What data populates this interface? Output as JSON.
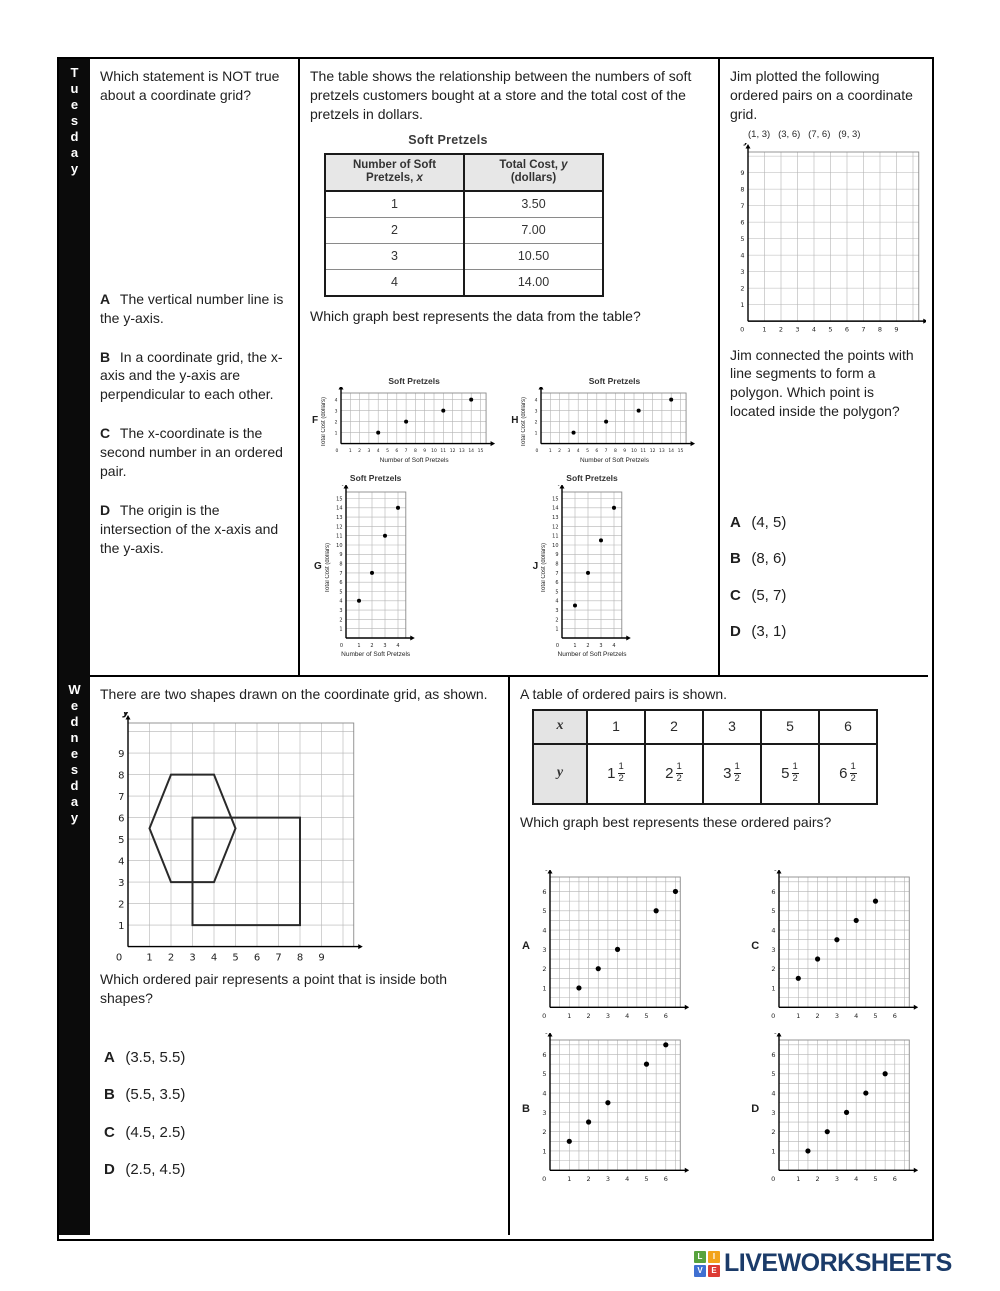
{
  "days": {
    "row1": "Tuesday",
    "row2": "Wednesday"
  },
  "tuesday": {
    "q1": {
      "question": "Which statement is NOT true about a coordinate grid?",
      "choices": [
        {
          "letter": "A",
          "text": "The vertical number line is the y-axis."
        },
        {
          "letter": "B",
          "text": "In a coordinate grid, the x-axis and the y-axis are perpendicular to each other."
        },
        {
          "letter": "C",
          "text": "The x-coordinate is the second number in an ordered pair."
        },
        {
          "letter": "D",
          "text": "The origin is the intersection of the x-axis and the y-axis."
        }
      ]
    },
    "q2": {
      "intro": "The table shows the relationship between the numbers of soft pretzels customers bought at a store and the total cost of the pretzels in dollars.",
      "table": {
        "title": "Soft Pretzels",
        "col1_line1": "Number of Soft",
        "col1_line2": "Pretzels,",
        "col1_var": "x",
        "col2_line1": "Total Cost,",
        "col2_var": "y",
        "col2_line2": "(dollars)",
        "rows": [
          {
            "x": "1",
            "cost": "3.50"
          },
          {
            "x": "2",
            "cost": "7.00"
          },
          {
            "x": "3",
            "cost": "10.50"
          },
          {
            "x": "4",
            "cost": "14.00"
          }
        ]
      },
      "question": "Which graph best represents the data from the table?"
    },
    "q3": {
      "intro": "Jim plotted the following ordered pairs on a coordinate grid.",
      "pairs": "(1, 3)   (3, 6)   (7, 6)   (9, 3)",
      "question": "Jim connected the points with line segments to form a polygon. Which point is located inside the polygon?",
      "choices": [
        {
          "letter": "A",
          "text": "(4, 5)"
        },
        {
          "letter": "B",
          "text": "(8, 6)"
        },
        {
          "letter": "C",
          "text": "(5, 7)"
        },
        {
          "letter": "D",
          "text": "(3, 1)"
        }
      ]
    }
  },
  "wednesday": {
    "q1": {
      "intro": "There are two shapes drawn on the coordinate grid, as shown.",
      "question": "Which ordered pair represents a point that is inside both shapes?",
      "choices": [
        {
          "letter": "A",
          "text": "(3.5, 5.5)"
        },
        {
          "letter": "B",
          "text": "(5.5, 3.5)"
        },
        {
          "letter": "C",
          "text": "(4.5, 2.5)"
        },
        {
          "letter": "D",
          "text": "(2.5, 4.5)"
        }
      ]
    },
    "q2": {
      "intro": "A table of ordered pairs is shown.",
      "table": {
        "x_header": "x",
        "y_header": "y",
        "x_values": [
          "1",
          "2",
          "3",
          "5",
          "6"
        ],
        "y_values": [
          {
            "whole": "1",
            "num": "1",
            "den": "2"
          },
          {
            "whole": "2",
            "num": "1",
            "den": "2"
          },
          {
            "whole": "3",
            "num": "1",
            "den": "2"
          },
          {
            "whole": "5",
            "num": "1",
            "den": "2"
          },
          {
            "whole": "6",
            "num": "1",
            "den": "2"
          }
        ]
      },
      "question": "Which graph best represents these ordered pairs?"
    }
  },
  "footer": {
    "logo_text": "LIVEWORKSHEETS",
    "logo_text_color": "#1b3b69",
    "logo_squares": [
      {
        "letter": "L",
        "color": "#57a23d"
      },
      {
        "letter": "I",
        "color": "#f2a31b"
      },
      {
        "letter": "V",
        "color": "#3f6fd1"
      },
      {
        "letter": "E",
        "color": "#dd3b33"
      }
    ]
  },
  "chart_data": {
    "f": {
      "type": "scatter",
      "label": "F",
      "title": "Soft Pretzels",
      "xlabel": "Number of Soft Pretzels",
      "ylabel": "Total Cost (dollars)",
      "axis_x": "x",
      "axis_y": "y",
      "x_ticks": [
        0,
        1,
        2,
        3,
        4,
        5,
        6,
        7,
        8,
        9,
        10,
        11,
        12,
        13,
        14,
        15
      ],
      "y_ticks": [
        1,
        2,
        3,
        4
      ],
      "x_grid_max": 15.6,
      "y_grid_max": 4.6,
      "grid_step": 1,
      "points": [
        [
          4,
          1
        ],
        [
          7,
          2
        ],
        [
          11,
          3
        ],
        [
          14,
          4
        ]
      ]
    },
    "h": {
      "type": "scatter",
      "label": "H",
      "title": "Soft Pretzels",
      "xlabel": "Number of Soft Pretzels",
      "ylabel": "Total Cost (dollars)",
      "axis_x": "x",
      "axis_y": "y",
      "x_ticks": [
        0,
        1,
        2,
        3,
        4,
        5,
        6,
        7,
        8,
        9,
        10,
        11,
        12,
        13,
        14,
        15
      ],
      "y_ticks": [
        1,
        2,
        3,
        4
      ],
      "x_grid_max": 15.6,
      "y_grid_max": 4.6,
      "grid_step": 1,
      "points": [
        [
          3.5,
          1
        ],
        [
          7,
          2
        ],
        [
          10.5,
          3
        ],
        [
          14,
          4
        ]
      ]
    },
    "g": {
      "type": "scatter",
      "label": "G",
      "title": "Soft Pretzels",
      "xlabel": "Number of Soft Pretzels",
      "ylabel": "Total Cost (dollars)",
      "axis_x": "x",
      "axis_y": "y",
      "x_ticks": [
        0,
        1,
        2,
        3,
        4
      ],
      "y_ticks": [
        1,
        2,
        3,
        4,
        5,
        6,
        7,
        8,
        9,
        10,
        11,
        12,
        13,
        14,
        15
      ],
      "x_grid_max": 4.6,
      "y_grid_max": 15.7,
      "grid_step": 1,
      "points": [
        [
          1,
          4
        ],
        [
          2,
          7
        ],
        [
          3,
          11
        ],
        [
          4,
          14
        ]
      ]
    },
    "j": {
      "type": "scatter",
      "label": "J",
      "title": "Soft Pretzels",
      "xlabel": "Number of Soft Pretzels",
      "ylabel": "Total Cost (dollars)",
      "axis_x": "x",
      "axis_y": "y",
      "x_ticks": [
        0,
        1,
        2,
        3,
        4
      ],
      "y_ticks": [
        1,
        2,
        3,
        4,
        5,
        6,
        7,
        8,
        9,
        10,
        11,
        12,
        13,
        14,
        15
      ],
      "x_grid_max": 4.6,
      "y_grid_max": 15.7,
      "grid_step": 1,
      "points": [
        [
          1,
          3.5
        ],
        [
          2,
          7
        ],
        [
          3,
          10.5
        ],
        [
          4,
          14
        ]
      ]
    },
    "jim": {
      "type": "scatter",
      "label": "",
      "title": "",
      "axis_x": "x",
      "axis_y": "y",
      "x_ticks": [
        0,
        1,
        2,
        3,
        4,
        5,
        6,
        7,
        8,
        9
      ],
      "y_ticks": [
        1,
        2,
        3,
        4,
        5,
        6,
        7,
        8,
        9
      ],
      "x_grid_max": 10.35,
      "y_grid_max": 10.25,
      "grid_step": 1,
      "points": []
    },
    "shapes": {
      "type": "scatter",
      "label": "",
      "title": "",
      "axis_x": "x",
      "axis_y": "y",
      "x_ticks": [
        0,
        1,
        2,
        3,
        4,
        5,
        6,
        7,
        8,
        9
      ],
      "y_ticks": [
        1,
        2,
        3,
        4,
        5,
        6,
        7,
        8,
        9
      ],
      "x_grid_max": 10.5,
      "y_grid_max": 10.4,
      "grid_step": 1,
      "points": [],
      "polygons": [
        [
          [
            2,
            8
          ],
          [
            4,
            8
          ],
          [
            5,
            5.5
          ],
          [
            4,
            3
          ],
          [
            2,
            3
          ],
          [
            1,
            5.5
          ]
        ],
        [
          [
            3,
            1
          ],
          [
            8,
            1
          ],
          [
            8,
            6
          ],
          [
            3,
            6
          ]
        ]
      ]
    },
    "a": {
      "type": "scatter",
      "label": "A",
      "axis_x": "x",
      "axis_y": "y",
      "x_ticks": [
        0,
        1,
        2,
        3,
        4,
        5,
        6
      ],
      "y_ticks": [
        1,
        2,
        3,
        4,
        5,
        6
      ],
      "x_grid_max": 6.75,
      "y_grid_max": 6.75,
      "grid_step": 0.5,
      "points": [
        [
          1.5,
          1
        ],
        [
          2.5,
          2
        ],
        [
          3.5,
          3
        ],
        [
          5.5,
          5
        ],
        [
          6.5,
          6
        ]
      ]
    },
    "c": {
      "type": "scatter",
      "label": "C",
      "axis_x": "x",
      "axis_y": "y",
      "x_ticks": [
        0,
        1,
        2,
        3,
        4,
        5,
        6
      ],
      "y_ticks": [
        1,
        2,
        3,
        4,
        5,
        6
      ],
      "x_grid_max": 6.75,
      "y_grid_max": 6.75,
      "grid_step": 0.5,
      "points": [
        [
          1,
          1.5
        ],
        [
          2,
          2.5
        ],
        [
          3,
          3.5
        ],
        [
          4,
          4.5
        ],
        [
          5,
          5.5
        ]
      ]
    },
    "b": {
      "type": "scatter",
      "label": "B",
      "axis_x": "x",
      "axis_y": "y",
      "x_ticks": [
        0,
        1,
        2,
        3,
        4,
        5,
        6
      ],
      "y_ticks": [
        1,
        2,
        3,
        4,
        5,
        6
      ],
      "x_grid_max": 6.75,
      "y_grid_max": 6.75,
      "grid_step": 0.5,
      "points": [
        [
          1,
          1.5
        ],
        [
          2,
          2.5
        ],
        [
          3,
          3.5
        ],
        [
          5,
          5.5
        ],
        [
          6,
          6.5
        ]
      ]
    },
    "d": {
      "type": "scatter",
      "label": "D",
      "axis_x": "x",
      "axis_y": "y",
      "x_ticks": [
        0,
        1,
        2,
        3,
        4,
        5,
        6
      ],
      "y_ticks": [
        1,
        2,
        3,
        4,
        5,
        6
      ],
      "x_grid_max": 6.75,
      "y_grid_max": 6.75,
      "grid_step": 0.5,
      "points": [
        [
          1.5,
          1
        ],
        [
          2.5,
          2
        ],
        [
          3.5,
          3
        ],
        [
          4.5,
          4
        ],
        [
          5.5,
          5
        ]
      ]
    }
  }
}
